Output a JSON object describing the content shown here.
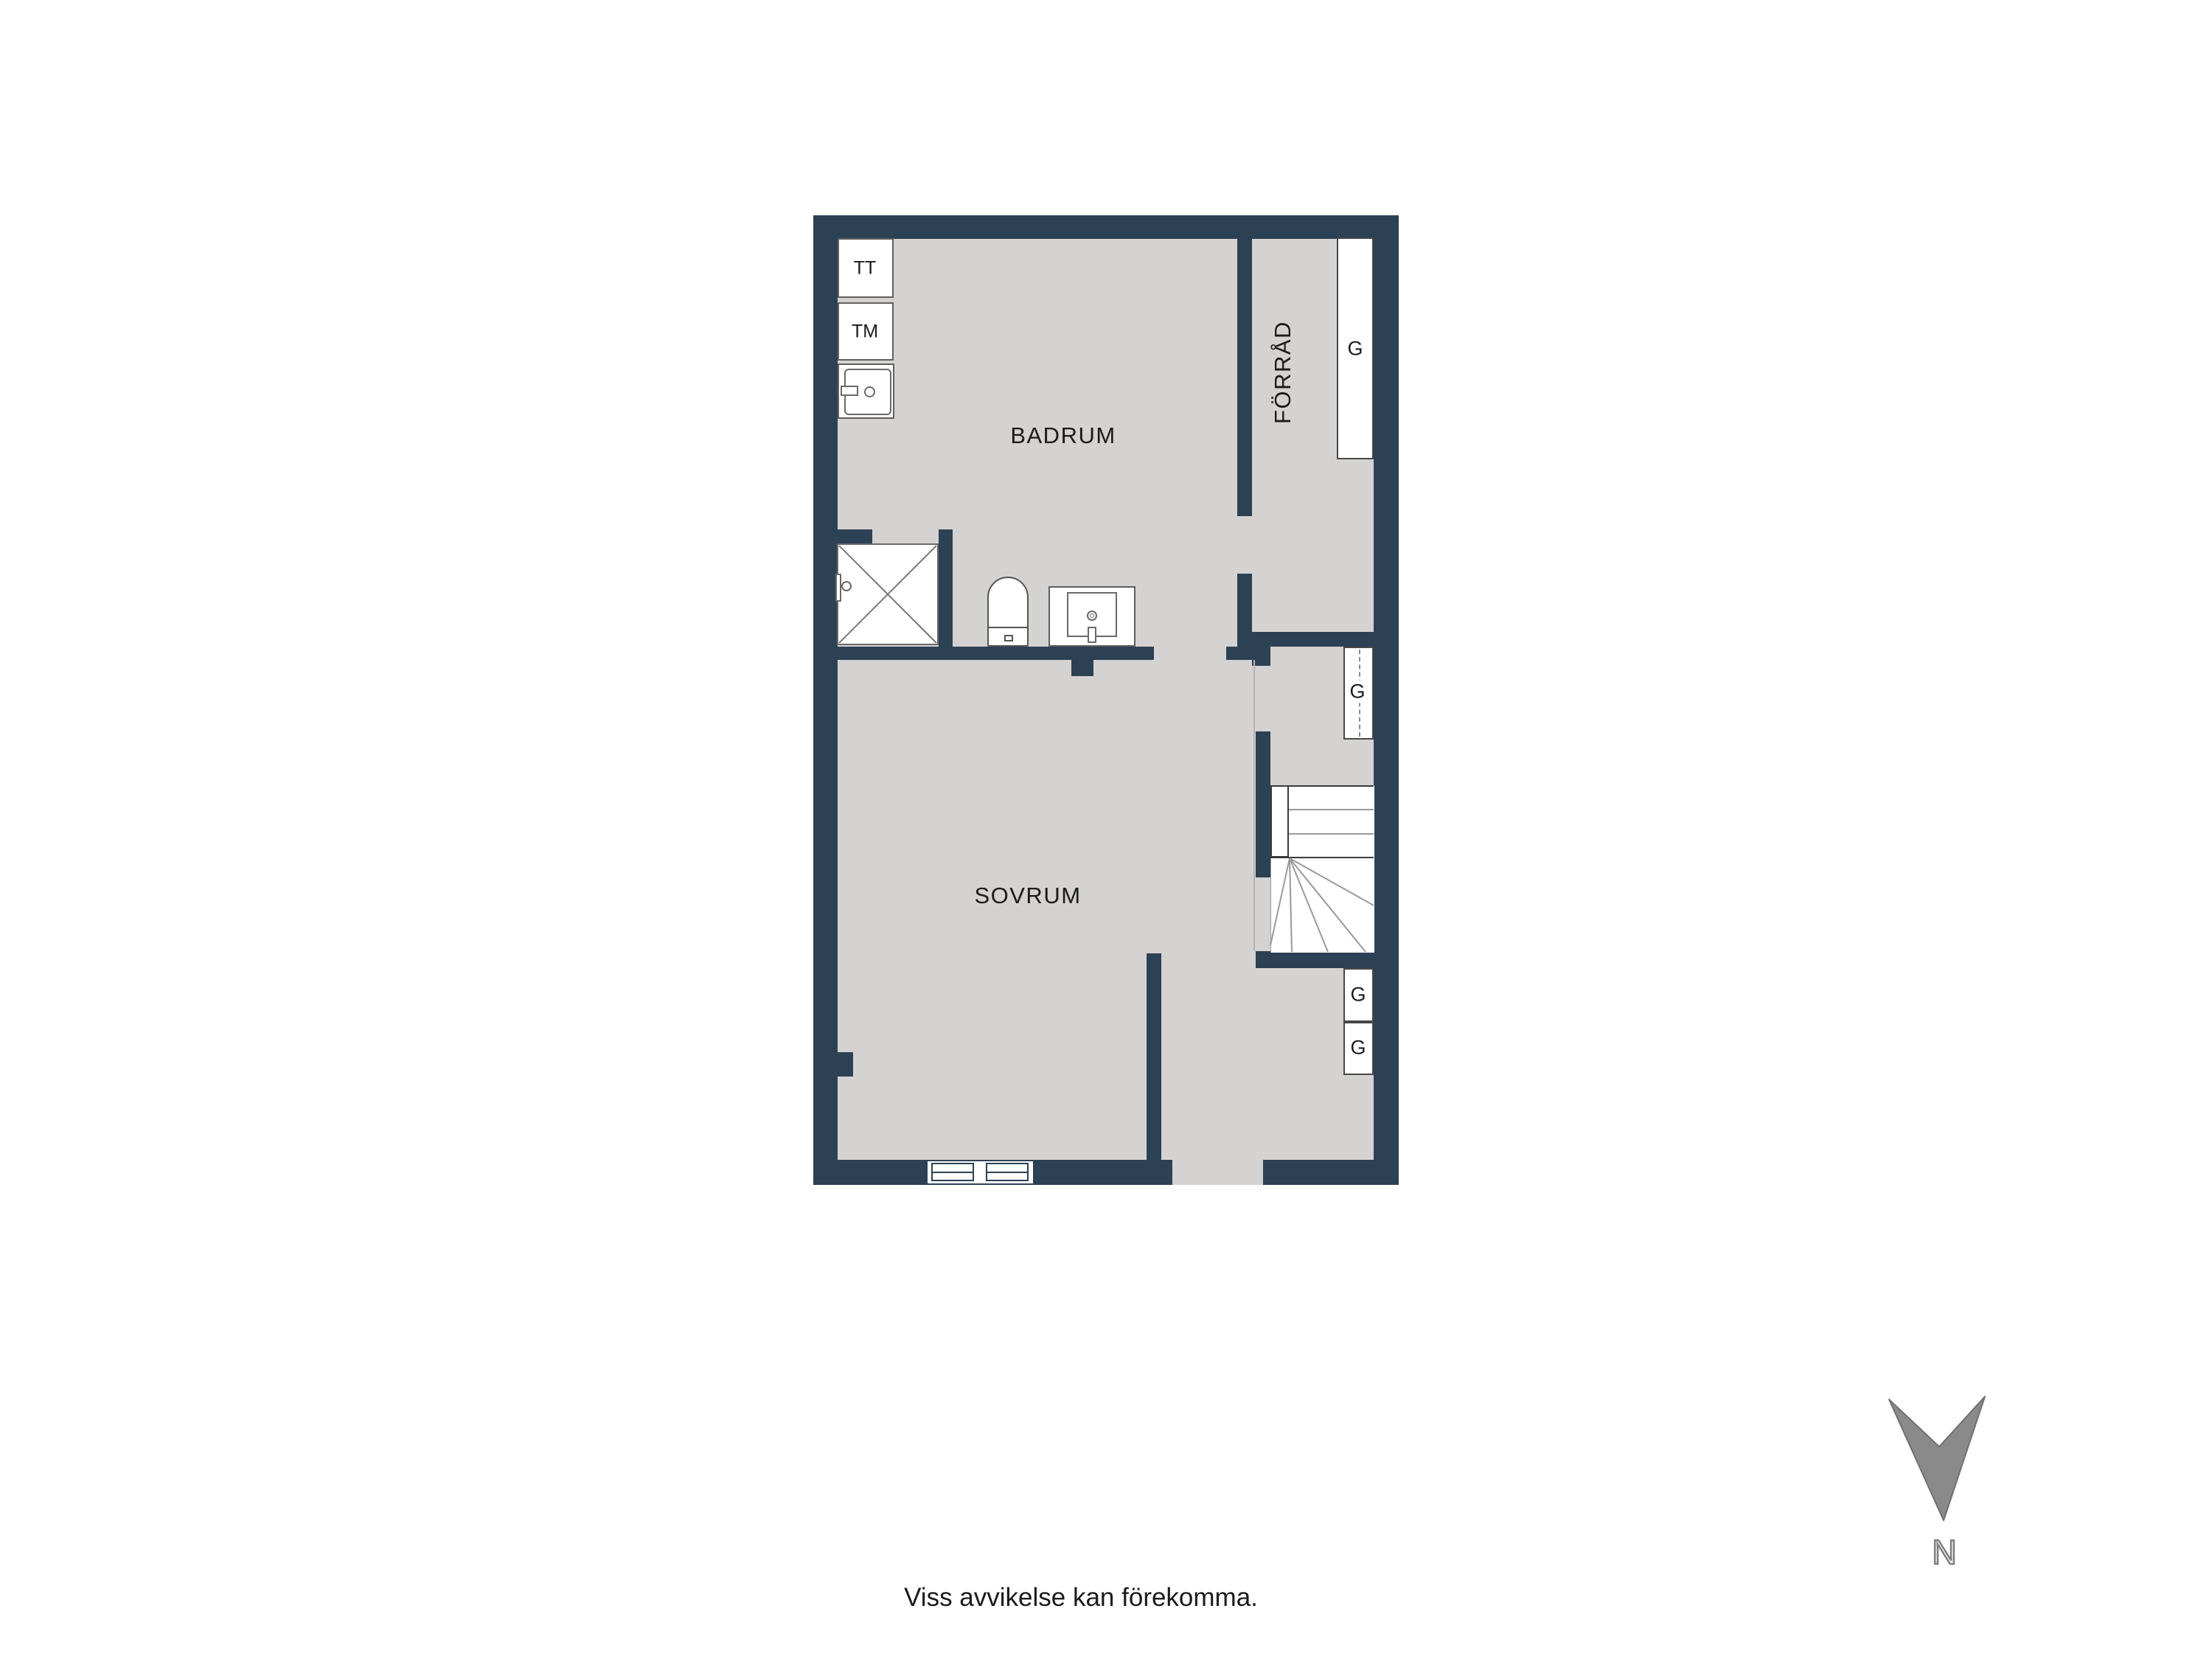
{
  "floorplan": {
    "rooms": {
      "badrum": "BADRUM",
      "sovrum": "SOVRUM",
      "forrad": "FÖRRÅD"
    },
    "appliances": {
      "tt": "TT",
      "tm": "TM"
    },
    "closets": {
      "forrad_g": "G",
      "hall_g": "G",
      "entre_g1": "G",
      "entre_g2": "G"
    }
  },
  "compass": {
    "north_label": "N"
  },
  "footer": {
    "disclaimer": "Viss avvikelse kan förekomma."
  },
  "colors": {
    "wall": "#2d4154",
    "floor": "#d4d3d1",
    "fixture_border": "#5f5f5f",
    "stair_line": "#999999",
    "north_arrow": "#8a8a8a"
  }
}
